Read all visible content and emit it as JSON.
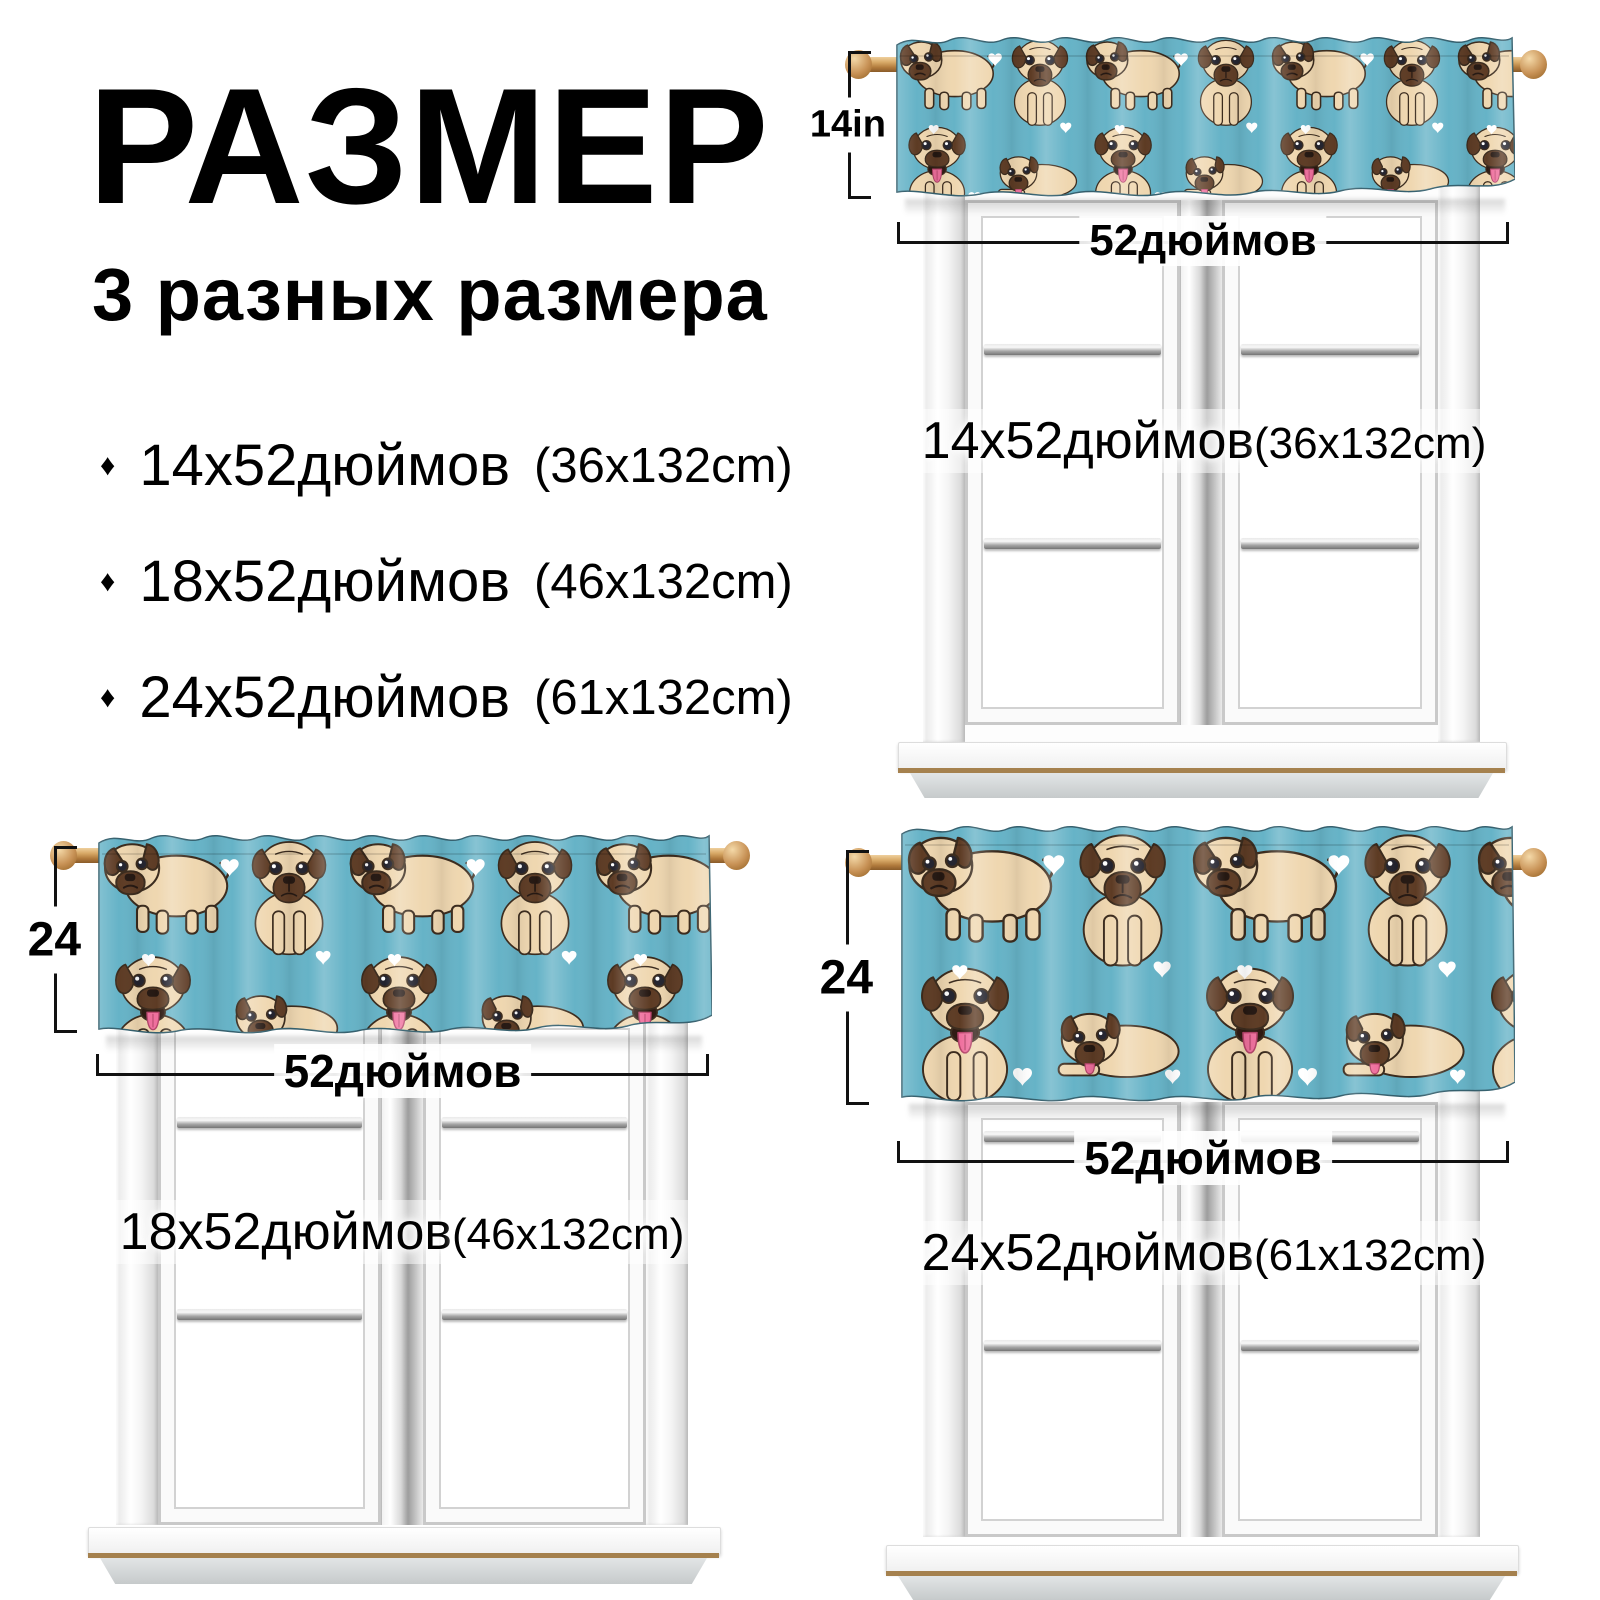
{
  "page": {
    "background": "#ffffff",
    "width": 1600,
    "height": 1600
  },
  "header": {
    "title": "РАЗМЕР",
    "subtitle": "3 разных размера"
  },
  "size_options": [
    {
      "bullet": "♦",
      "size": "14х52дюймов",
      "metric": "(36х132cm)"
    },
    {
      "bullet": "♦",
      "size": "18х52дюймов",
      "metric": "(46х132cm)"
    },
    {
      "bullet": "♦",
      "size": "24х52дюймов",
      "metric": "(61х132cm)"
    }
  ],
  "scenes": [
    {
      "name": "valance-14-inch",
      "height_label": "14in",
      "width_label": "52дюймов",
      "size": "14х52дюймов",
      "metric": "(36х132cm)"
    },
    {
      "name": "valance-18-inch",
      "height_label": "24",
      "width_label": "52дюймов",
      "size": "18х52дюймов",
      "metric": "(46х132cm)"
    },
    {
      "name": "valance-24-inch",
      "height_label": "24",
      "width_label": "52дюймов",
      "size": "24х52дюймов",
      "metric": "(61х132cm)"
    }
  ],
  "curtain": {
    "pattern": "cartoon pugs with white hearts",
    "background_color": "#66b3c7",
    "pug_body_color": "#efd7b0",
    "pug_ear_color": "#5d3b24",
    "tongue_color": "#ef6f9d",
    "heart_color": "#ffffff",
    "rod_wood_color": "#c89456"
  },
  "window": {
    "frame_color": "#ffffff",
    "metal_bar_color": "#9a9a9a",
    "sill_trim_color": "#a5814e",
    "apron_color": "#c6cacb"
  }
}
